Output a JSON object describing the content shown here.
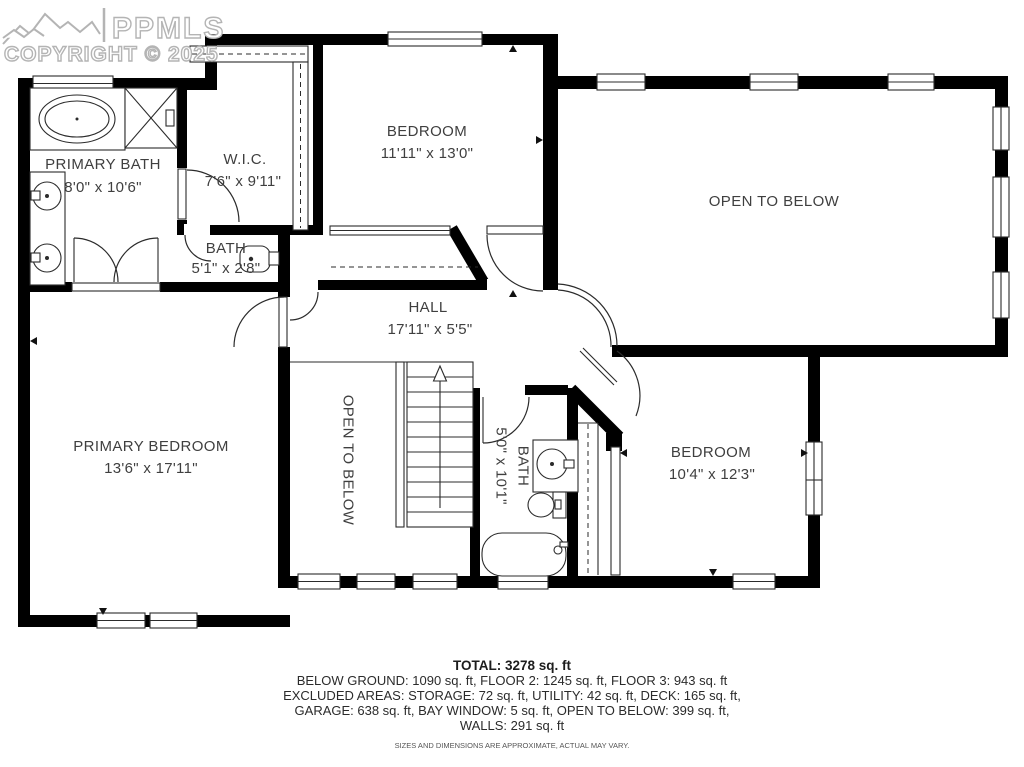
{
  "watermark": {
    "brand": "PPMLS",
    "copyright": "COPYRIGHT © 2025"
  },
  "rooms": {
    "primary_bath": {
      "name": "PRIMARY BATH",
      "dims": "8'0\" x 10'6\""
    },
    "wic": {
      "name": "W.I.C.",
      "dims": "7'6\" x 9'11\""
    },
    "bedroom_top": {
      "name": "BEDROOM",
      "dims": "11'11\" x 13'0\""
    },
    "open_to_below": {
      "name": "OPEN TO BELOW"
    },
    "bath_small": {
      "name": "BATH",
      "dims": "5'1\" x 2'8\""
    },
    "hall": {
      "name": "HALL",
      "dims": "17'11\" x 5'5\""
    },
    "primary_bedroom": {
      "name": "PRIMARY BEDROOM",
      "dims": "13'6\" x 17'11\""
    },
    "open_to_below_stairs": {
      "name": "OPEN TO BELOW"
    },
    "bath_vertical": {
      "name": "BATH",
      "dims": "5'0\" x 10'1\""
    },
    "bedroom_right": {
      "name": "BEDROOM",
      "dims": "10'4\" x 12'3\""
    }
  },
  "summary": {
    "total": "TOTAL: 3278 sq. ft",
    "line1": "BELOW GROUND: 1090 sq. ft, FLOOR 2: 1245 sq. ft, FLOOR 3: 943 sq. ft",
    "line2": "EXCLUDED AREAS: STORAGE: 72 sq. ft, UTILITY: 42 sq. ft, DECK: 165 sq. ft,",
    "line3": "GARAGE: 638 sq. ft, BAY WINDOW: 5 sq. ft, OPEN TO BELOW: 399 sq. ft,",
    "line4": "WALLS: 291 sq. ft",
    "disclaimer": "SIZES AND DIMENSIONS ARE APPROXIMATE, ACTUAL MAY VARY."
  },
  "colors": {
    "wall": "#000000",
    "line": "#2b2b2b",
    "text": "#3f3f3f",
    "watermark": "#b4b4b4"
  }
}
